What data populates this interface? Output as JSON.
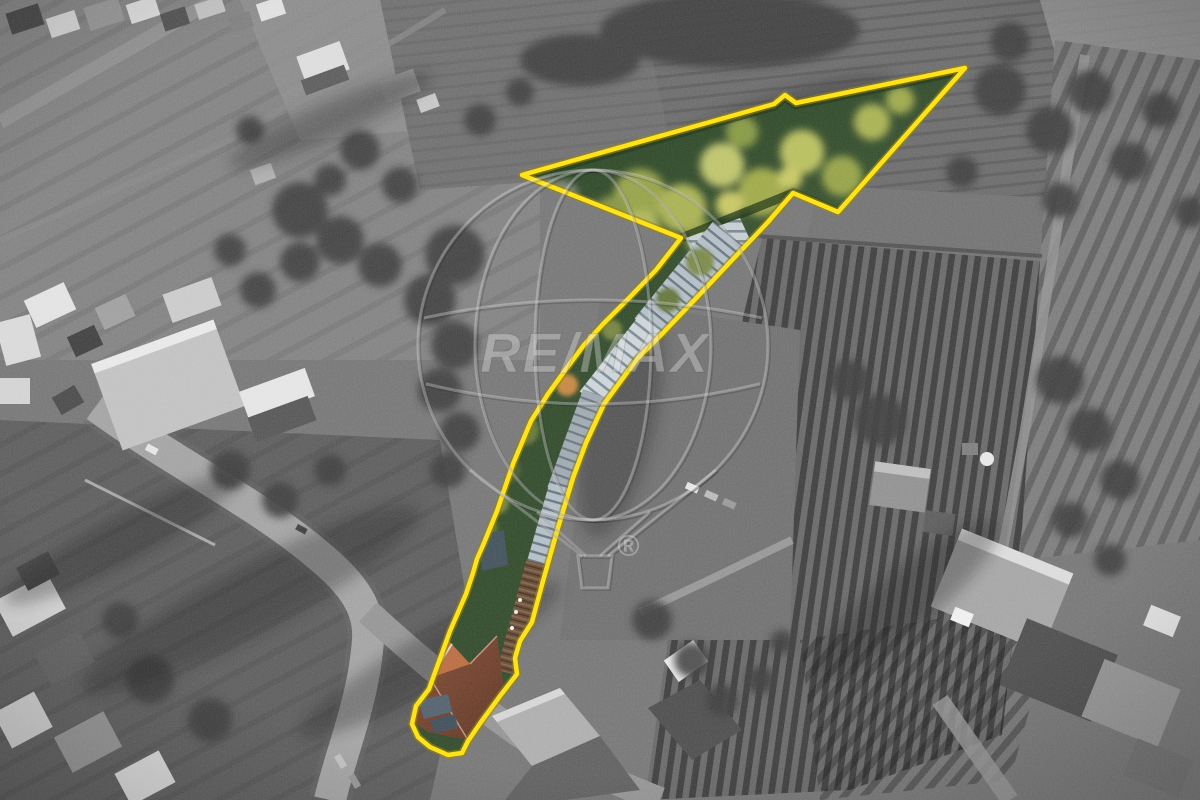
{
  "photo": {
    "description": "Black-and-white aerial drone photograph of a village with fields and vineyards; one long narrow property is shown in colour and outlined in yellow, widening into a large green field shaped like an arrow pointing north-east, with greenhouses and an orange-roofed house along the strip.",
    "watermark": {
      "brand": "RE/MAX",
      "registered": "®"
    },
    "colors": {
      "outline_yellow": "#ffdf10",
      "outline_halo": "#8a7a00",
      "field_green": "#2c4426",
      "foliage_yellow_green": "#a3ac4c",
      "greenhouse_gray_blue": "#b7c2ca",
      "roof_rust_brown": "#5f4430",
      "roof_orange": "#7a452f",
      "roof_orange_bright": "#b5653a",
      "background_gray": "#6f6f6f"
    }
  }
}
